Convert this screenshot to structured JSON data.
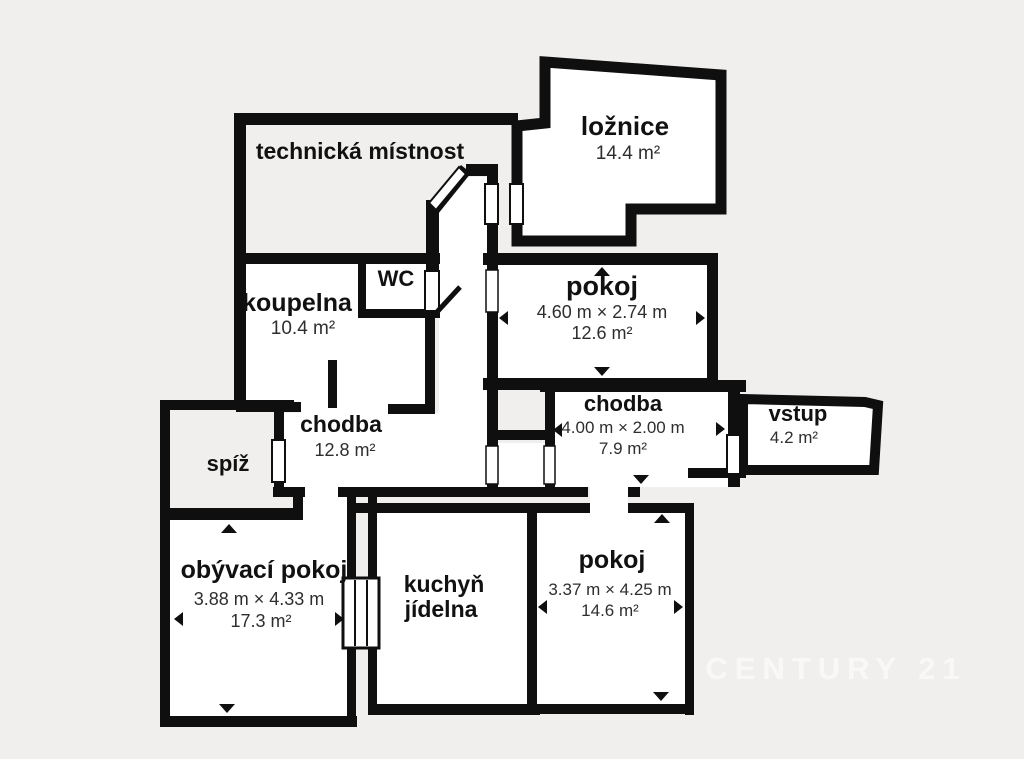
{
  "plan": {
    "background_color": "#f0efed",
    "wall_color": "#0f0f0f",
    "room_fill_color": "#ffffff",
    "watermark": "CENTURY 21",
    "rooms": {
      "technicka_mistnost": {
        "name": "technická místnost"
      },
      "loznice": {
        "name": "ložnice",
        "area": "14.4 m²"
      },
      "koupelna": {
        "name": "koupelna",
        "area": "10.4 m²"
      },
      "wc": {
        "name": "WC"
      },
      "pokoj_stredni": {
        "name": "pokoj",
        "dims": "4.60 m × 2.74 m",
        "area": "12.6 m²"
      },
      "chodba_stredni": {
        "name": "chodba",
        "area": "12.8 m²"
      },
      "chodba_prava": {
        "name": "chodba",
        "dims": "4.00 m × 2.00 m",
        "area": "7.9 m²"
      },
      "vstup": {
        "name": "vstup",
        "area": "4.2 m²"
      },
      "spiz": {
        "name": "spíž"
      },
      "obyvaci_pokoj": {
        "name": "obývací pokoj",
        "dims": "3.88 m × 4.33 m",
        "area": "17.3 m²"
      },
      "kuchyn": {
        "name": "kuchyň",
        "name_line2": "jídelna"
      },
      "pokoj_dolni": {
        "name": "pokoj",
        "dims": "3.37 m × 4.25 m",
        "area": "14.6 m²"
      }
    }
  }
}
